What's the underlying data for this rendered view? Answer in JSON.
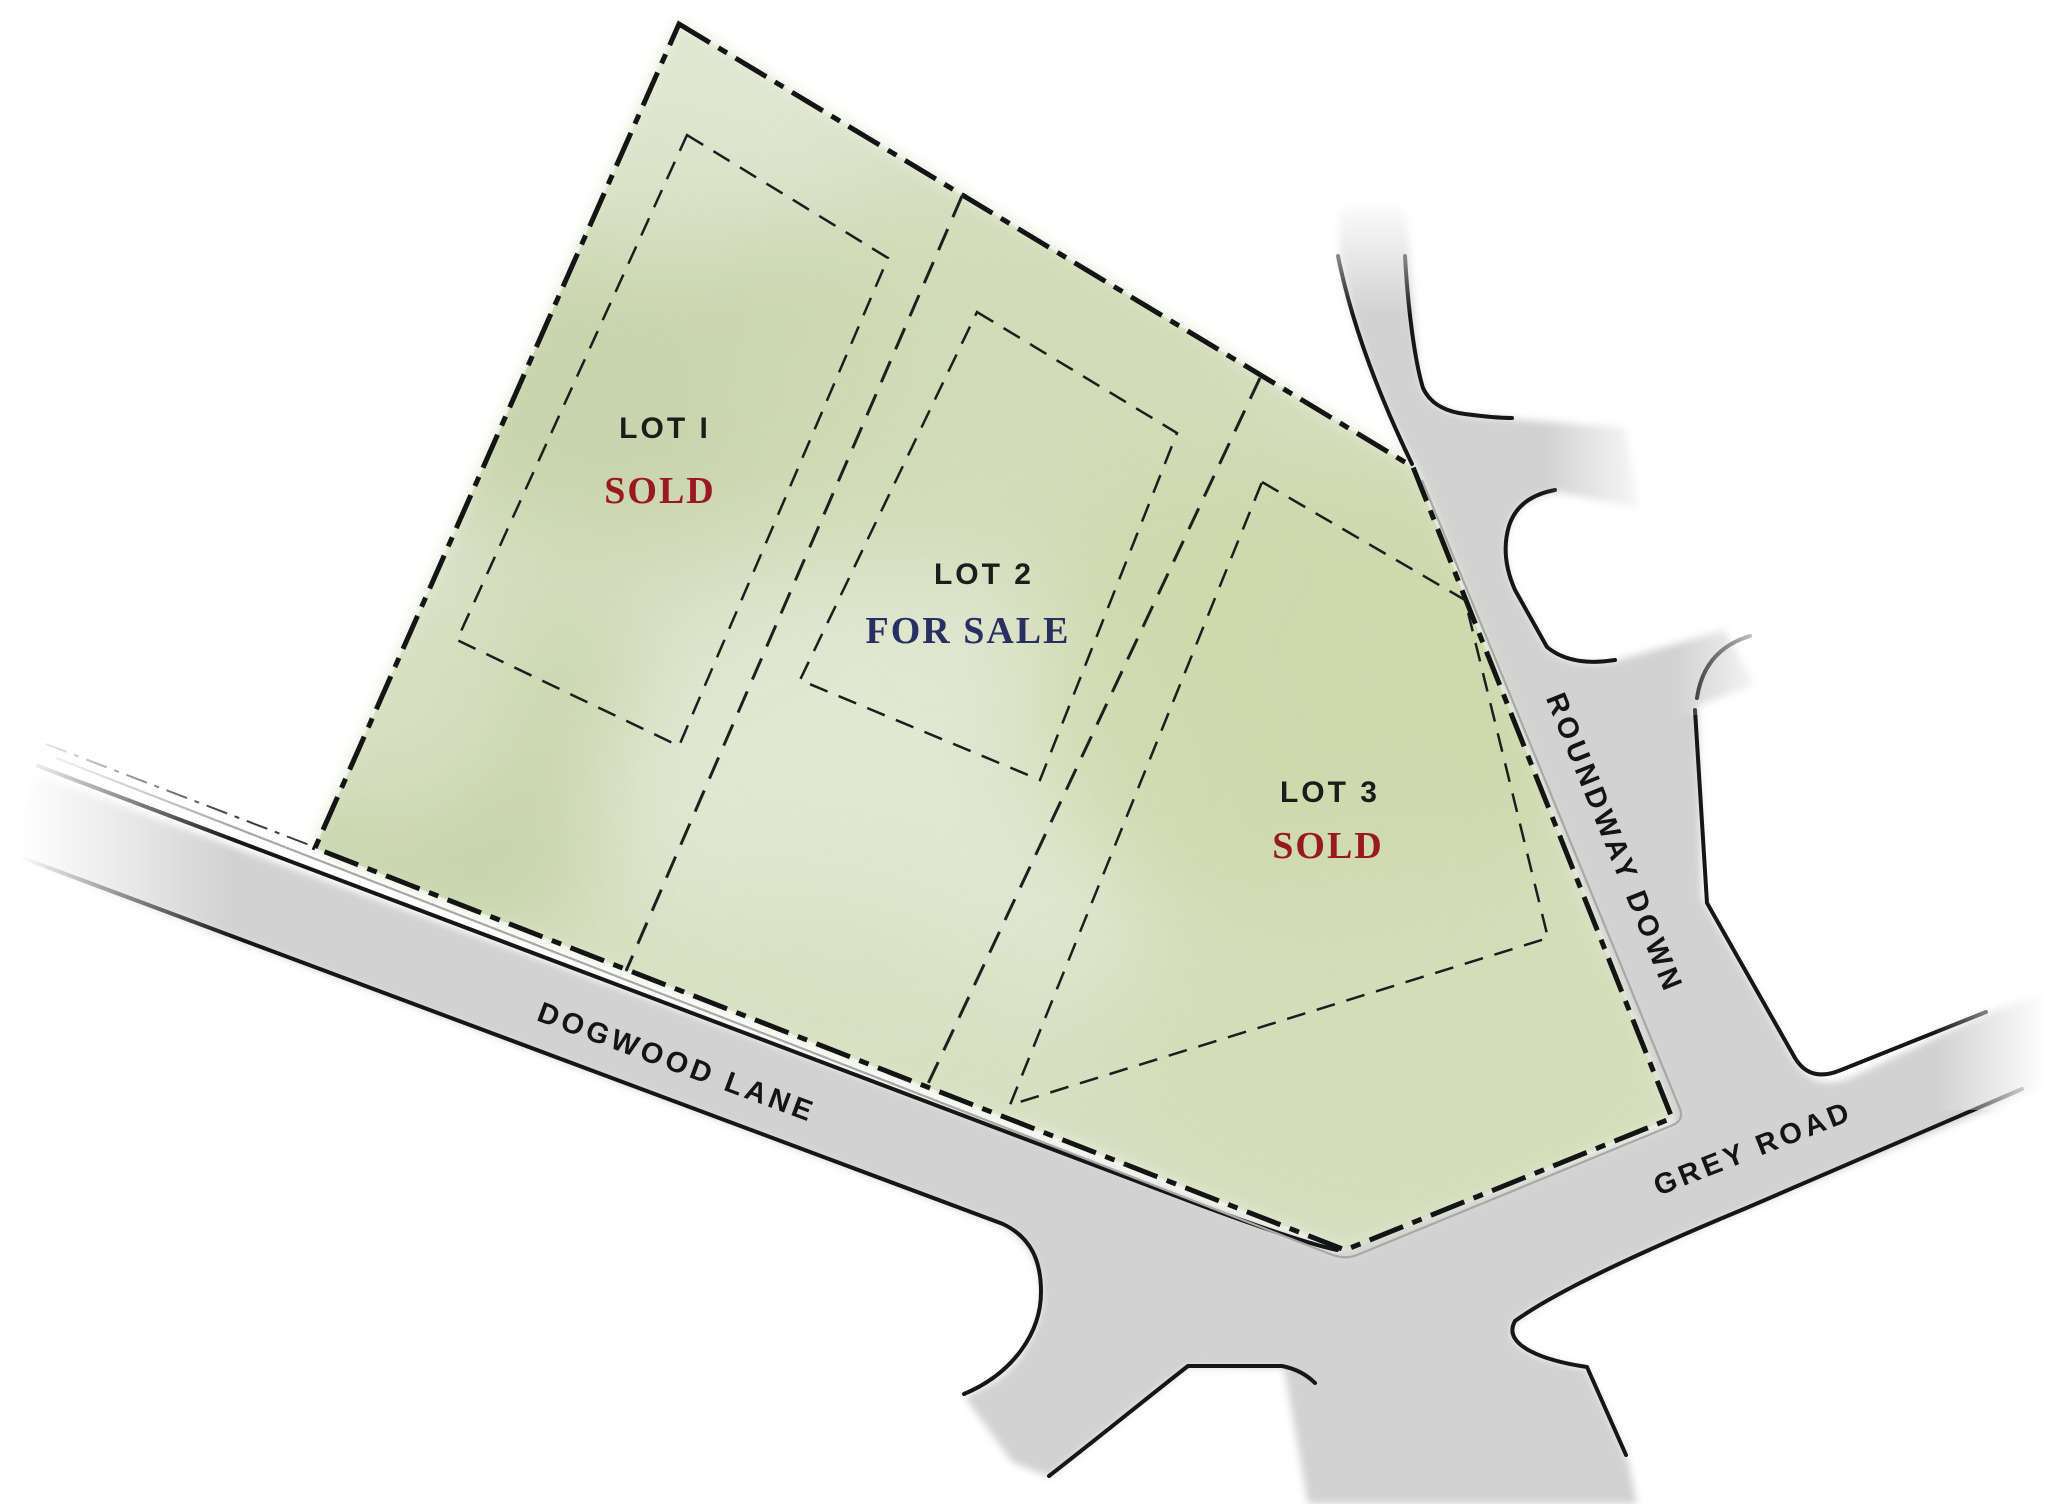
{
  "plan": {
    "title": "Lot site plan",
    "lots": [
      {
        "name": "LOT I",
        "status": "SOLD",
        "status_color": "#9a191c"
      },
      {
        "name": "LOT 2",
        "status": "FOR SALE",
        "status_color": "#273060"
      },
      {
        "name": "LOT 3",
        "status": "SOLD",
        "status_color": "#9a191c"
      }
    ],
    "roads": [
      {
        "name": "DOGWOOD LANE"
      },
      {
        "name": "ROUNDWAY DOWN"
      },
      {
        "name": "GREY ROAD"
      }
    ],
    "colors": {
      "background": "#ffffff",
      "parcel_green": "#dce4c9",
      "road_gray": "#d2d2d2",
      "line_black": "#161616",
      "sold_red": "#9a191c",
      "for_sale_navy": "#273060"
    }
  }
}
